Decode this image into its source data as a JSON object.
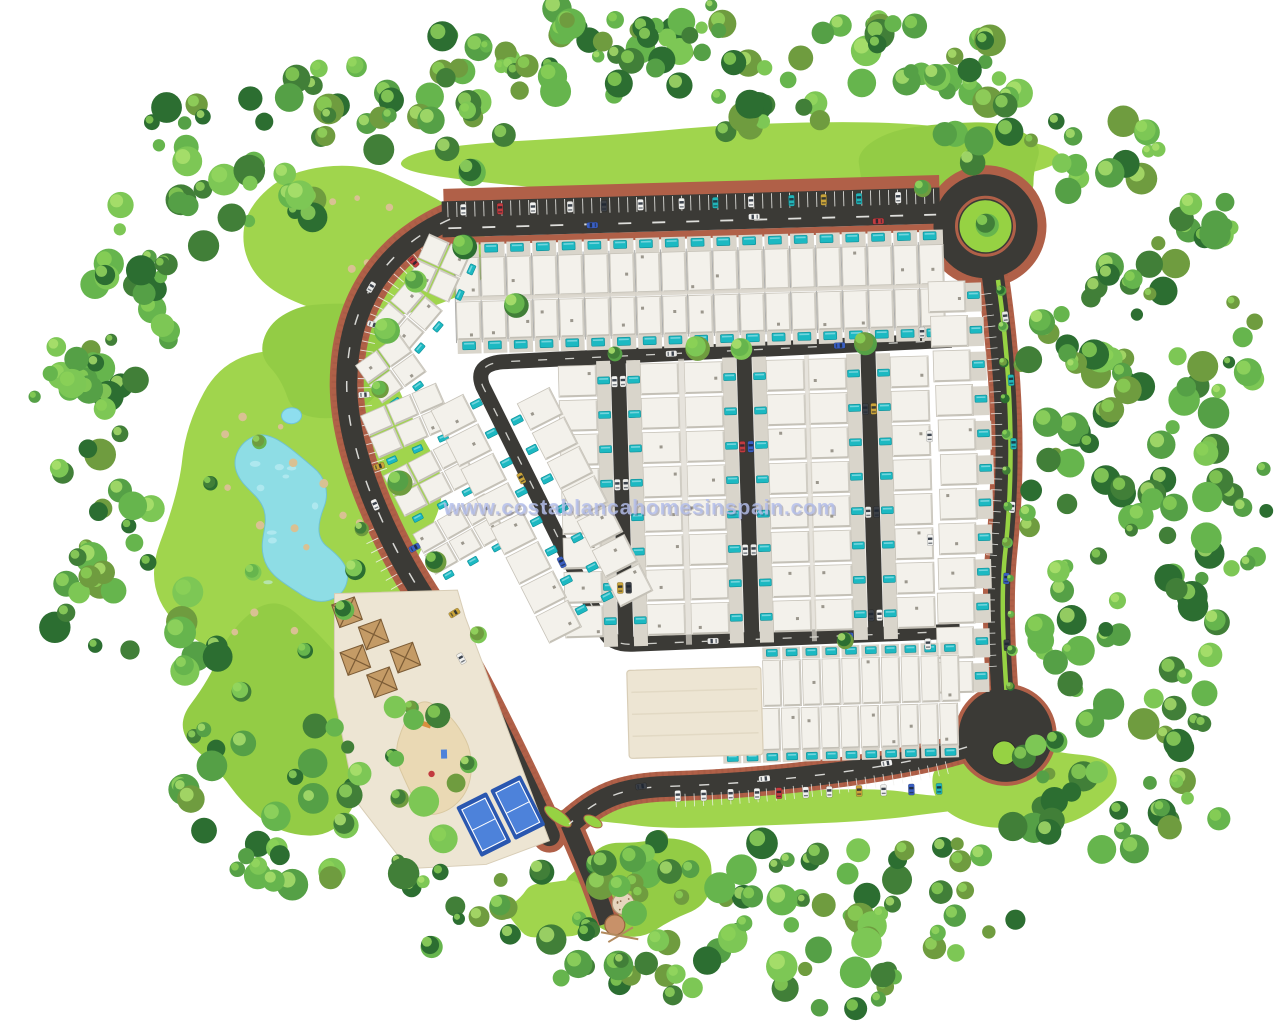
{
  "image_type": "aerial-3d-masterplan-render",
  "watermark": {
    "text": "www.costablancahomesinspain.com"
  },
  "palette": {
    "background": "#ffffff",
    "road": "#3b3a36",
    "road_line": "#f2f2ee",
    "sidewalk_brick": "#b06048",
    "sidewalk_brick_dark": "#94503b",
    "lawn": "#a0d54d",
    "lawn_alt": "#93cc45",
    "water": "#8edeee",
    "water_light": "#c9f0f7",
    "pool": "#1cb9c2",
    "pool_dark": "#0e8d96",
    "roof": "#f3f1eb",
    "roof_edge": "#c7c3b9",
    "roof_shadow": "#b8b4aa",
    "patio": "#d9d5cb",
    "alley": "#dbd7cd",
    "wall_dark": "#4a4a46",
    "plaza": "#ede5d3",
    "plaza_edge": "#d8cdb6",
    "sand": "#ead9b4",
    "pergola": "#c49b66",
    "pergola_dark": "#7c5c36",
    "court_blue": "#2a57b0",
    "court_inner": "#4d82da",
    "court_line": "#ffffff",
    "tower_tan": "#c89169",
    "tower_light": "#e6d6be",
    "island_green": "#96d243",
    "tree_greens": [
      "#2c6e31",
      "#417f38",
      "#55a046",
      "#66b54d",
      "#7dc755",
      "#6f9c3f"
    ],
    "tree_light_greens": [
      "#95d75f",
      "#aee26e",
      "#8cd257"
    ],
    "car_colors": [
      "#f2f2f0",
      "#f4f4f2",
      "#e9e9e7",
      "#c23b3f",
      "#3a5fc4",
      "#22b4b8",
      "#caa43a",
      "#3c4046",
      "#f2f2f0",
      "#f2f2f0"
    ],
    "watermark_fill": "#b4bfeb",
    "watermark_shadow": "#3a3558"
  },
  "site": {
    "counts": {
      "top_terrace_units": 19,
      "middle_streets": 3,
      "units_per_street_side": 8,
      "bottom_row_units": 10,
      "bottom_row2_units": 12,
      "right_row_units": 12,
      "fan_clusters": 6,
      "diagonal_row_units": 8,
      "paddle_courts": 2,
      "pergolas": 5,
      "roundabouts": 2,
      "lakes": 1
    }
  }
}
